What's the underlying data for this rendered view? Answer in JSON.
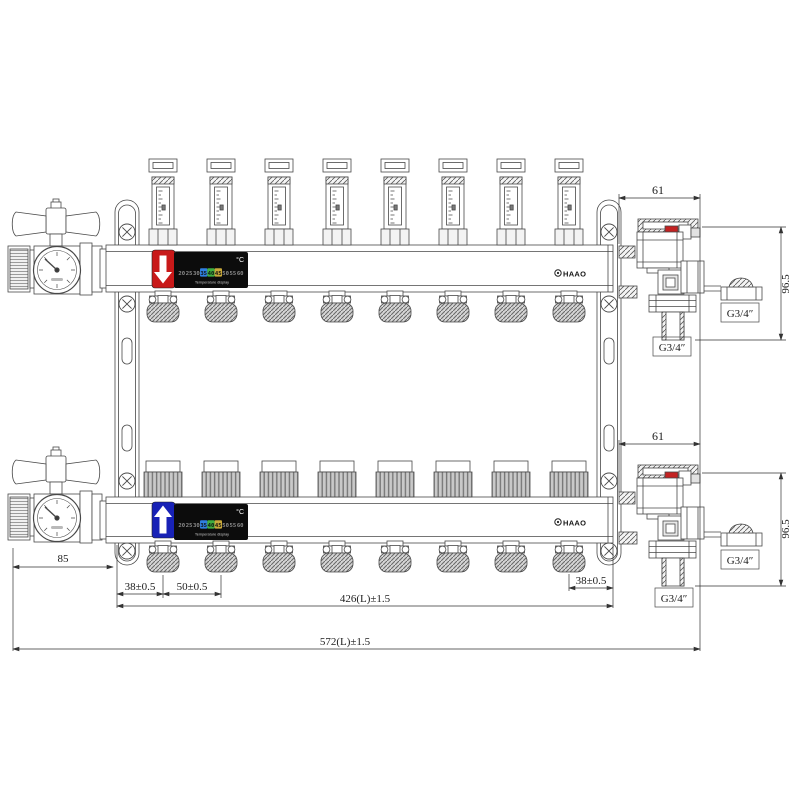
{
  "drawing": {
    "brand": "HAAO",
    "circuits": 8
  },
  "supply_display": {
    "arrow": "down",
    "block_color": "#c81919"
  },
  "return_display": {
    "arrow": "up",
    "block_color": "#1822b6"
  },
  "temperature_display": {
    "unit_label": "°C",
    "caption": "Temperature display",
    "scale": [
      {
        "label": "20",
        "color": "#8c8c8c"
      },
      {
        "label": "25",
        "color": "#8c8c8c"
      },
      {
        "label": "30",
        "color": "#8c8c8c"
      },
      {
        "label": "35",
        "color": "#101010",
        "bg": "#2f7fe0"
      },
      {
        "label": "40",
        "color": "#101010",
        "bg": "#3fae3f"
      },
      {
        "label": "45",
        "color": "#101010",
        "bg": "#c9a93a"
      },
      {
        "label": "50",
        "color": "#8c8c8c"
      },
      {
        "label": "55",
        "color": "#8c8c8c"
      },
      {
        "label": "60",
        "color": "#8c8c8c"
      }
    ]
  },
  "dimensions": {
    "top_offset": "61",
    "top_height": "96.5",
    "bottom_offset": "61",
    "bottom_height": "96.5",
    "valve_length": "85",
    "end_spacing_left": "38±0.5",
    "port_spacing": "50±0.5",
    "end_spacing_right": "38±0.5",
    "manifold_length": "426(L)±1.5",
    "total_length": "572(L)±1.5",
    "drain_thread_top": "G3/4″",
    "cap_thread_top": "G3/4″",
    "drain_thread_bottom": "G3/4″",
    "cap_thread_bottom": "G3/4″"
  }
}
